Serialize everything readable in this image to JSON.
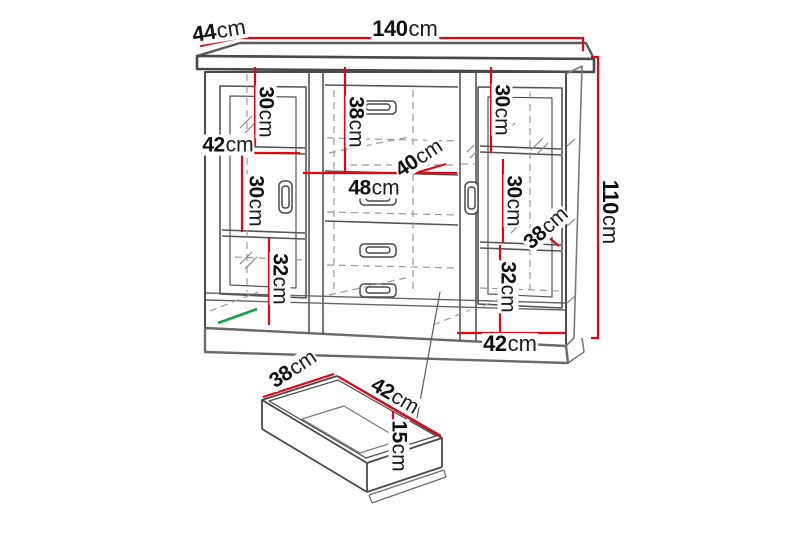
{
  "diagram": {
    "kind": "furniture-dimension-drawing",
    "unit": "cm",
    "colors": {
      "dimension_line": "#e30613",
      "highlight_line": "#18a23e",
      "outline": "#3f3f3f"
    },
    "dims": {
      "cabinet_width": {
        "v": "140",
        "u": "cm"
      },
      "cabinet_depth": {
        "v": "44",
        "u": "cm"
      },
      "cabinet_height": {
        "v": "110",
        "u": "cm"
      },
      "left_top_section": {
        "v": "30",
        "u": "cm"
      },
      "left_door_width": {
        "v": "42",
        "u": "cm"
      },
      "left_mid_section": {
        "v": "30",
        "u": "cm"
      },
      "left_bottom_section": {
        "v": "32",
        "u": "cm"
      },
      "mid_top_section": {
        "v": "38",
        "u": "cm"
      },
      "mid_inner_depth": {
        "v": "40",
        "u": "cm"
      },
      "mid_drawer_width": {
        "v": "48",
        "u": "cm"
      },
      "right_top_section": {
        "v": "30",
        "u": "cm"
      },
      "right_mid_section": {
        "v": "30",
        "u": "cm"
      },
      "right_inner_depth": {
        "v": "38",
        "u": "cm"
      },
      "right_bottom_section": {
        "v": "32",
        "u": "cm"
      },
      "right_door_width": {
        "v": "42",
        "u": "cm"
      },
      "drawer_depth": {
        "v": "38",
        "u": "cm"
      },
      "drawer_width": {
        "v": "42",
        "u": "cm"
      },
      "drawer_height": {
        "v": "15",
        "u": "cm"
      }
    }
  }
}
